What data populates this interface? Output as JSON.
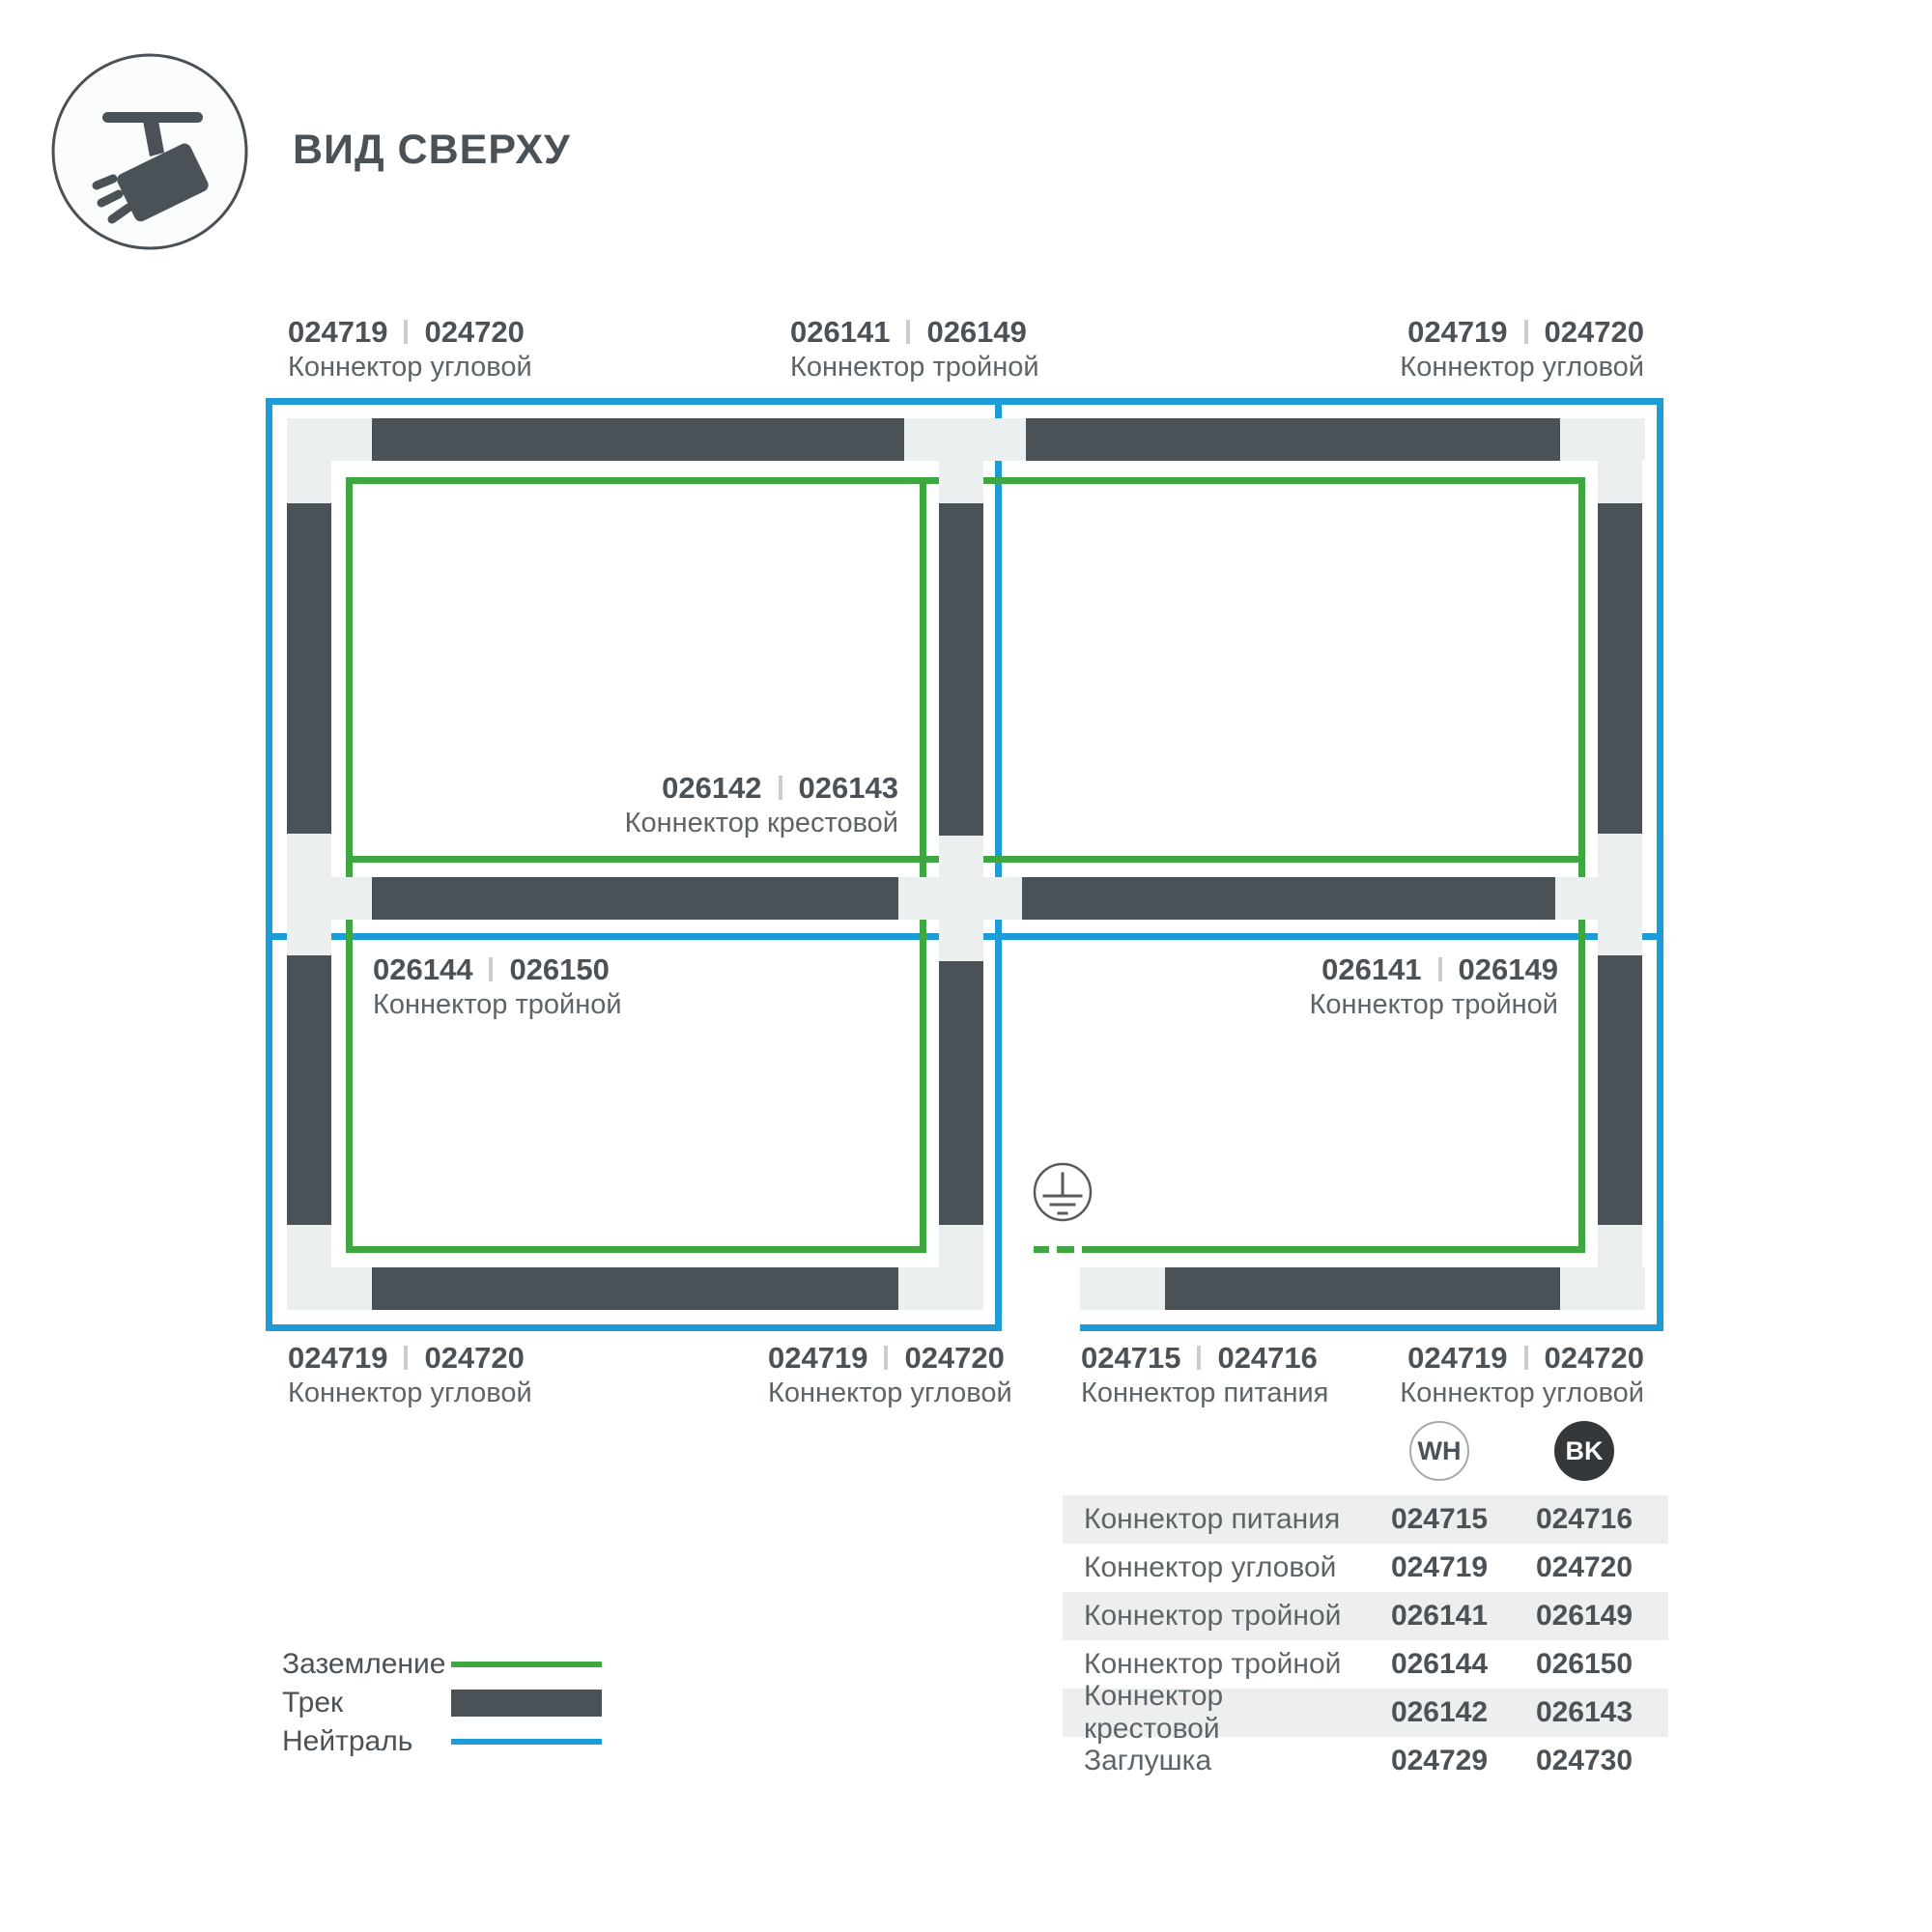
{
  "header": {
    "title": "ВИД СВЕРХУ",
    "icon": "track-spotlight-icon"
  },
  "colors": {
    "track": "#4A5157",
    "ground": "#3EA742",
    "neutral": "#1E9CD8",
    "connector": "#ECEFEF",
    "text_dark": "#4A5157",
    "text_soft": "#5D6468",
    "table_row": "#EDEFEF",
    "bk_fill": "#34383B"
  },
  "diagram": {
    "labels": [
      {
        "id": "top-left",
        "code_wh": "024719",
        "code_bk": "024720",
        "name": "Коннектор угловой"
      },
      {
        "id": "top-center",
        "code_wh": "026141",
        "code_bk": "026149",
        "name": "Коннектор тройной"
      },
      {
        "id": "top-right",
        "code_wh": "024719",
        "code_bk": "024720",
        "name": "Коннектор угловой"
      },
      {
        "id": "center-cross",
        "code_wh": "026142",
        "code_bk": "026143",
        "name": "Коннектор крестовой"
      },
      {
        "id": "mid-left",
        "code_wh": "026144",
        "code_bk": "026150",
        "name": "Коннектор тройной"
      },
      {
        "id": "mid-right",
        "code_wh": "026141",
        "code_bk": "026149",
        "name": "Коннектор тройной"
      },
      {
        "id": "bottom-left",
        "code_wh": "024719",
        "code_bk": "024720",
        "name": "Коннектор угловой"
      },
      {
        "id": "bottom-center",
        "code_wh": "024719",
        "code_bk": "024720",
        "name": "Коннектор угловой"
      },
      {
        "id": "bottom-feed",
        "code_wh": "024715",
        "code_bk": "024716",
        "name": "Коннектор питания"
      },
      {
        "id": "bottom-right",
        "code_wh": "024719",
        "code_bk": "024720",
        "name": "Коннектор угловой"
      }
    ],
    "ground_symbol": "earth-ground"
  },
  "legend": {
    "items": [
      {
        "label": "Заземление",
        "swatch": "ground-line"
      },
      {
        "label": "Трек",
        "swatch": "track-bar"
      },
      {
        "label": "Нейтраль",
        "swatch": "neutral-line"
      }
    ]
  },
  "table": {
    "columns": [
      {
        "code": "WH"
      },
      {
        "code": "BK"
      }
    ],
    "rows": [
      {
        "name": "Коннектор питания",
        "wh": "024715",
        "bk": "024716"
      },
      {
        "name": "Коннектор угловой",
        "wh": "024719",
        "bk": "024720"
      },
      {
        "name": "Коннектор тройной",
        "wh": "026141",
        "bk": "026149"
      },
      {
        "name": "Коннектор тройной",
        "wh": "026144",
        "bk": "026150"
      },
      {
        "name": "Коннектор крестовой",
        "wh": "026142",
        "bk": "026143"
      },
      {
        "name": "Заглушка",
        "wh": "024729",
        "bk": "024730"
      }
    ]
  }
}
